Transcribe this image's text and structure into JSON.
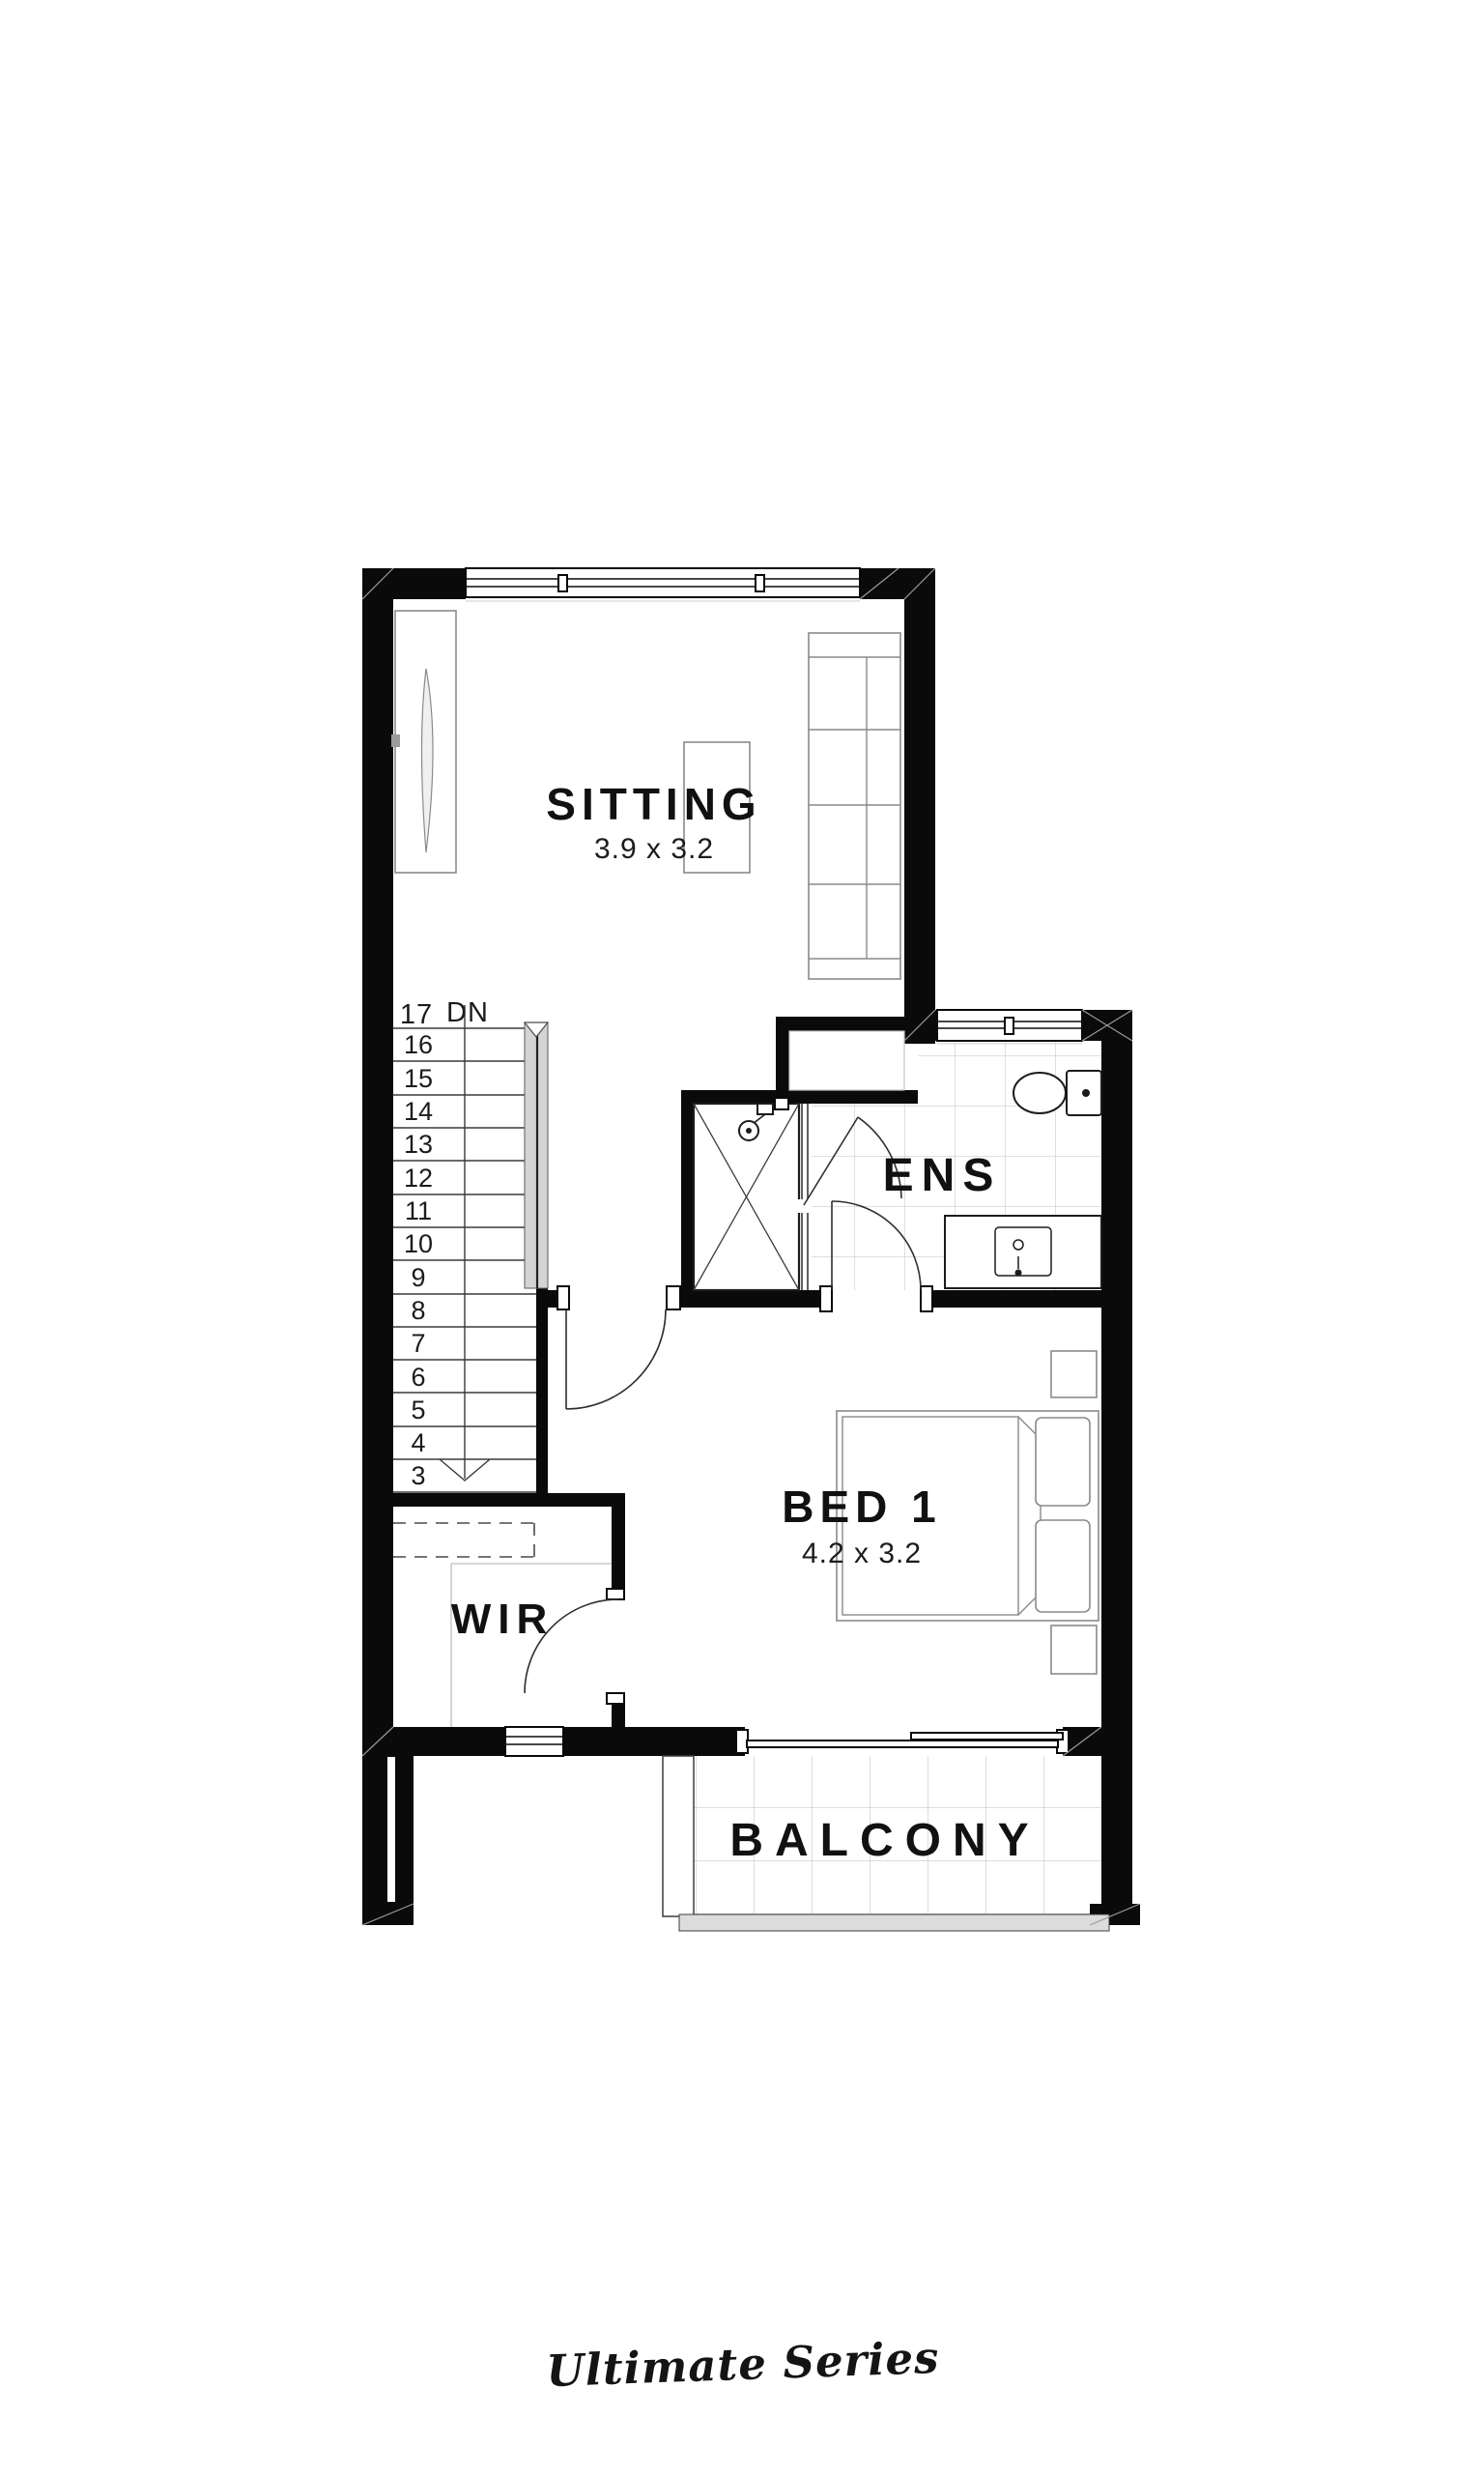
{
  "branding": {
    "series_label": "Ultimate Series"
  },
  "rooms": {
    "sitting": {
      "name": "SITTING",
      "dimensions": "3.9 x 3.2"
    },
    "ens": {
      "name": "ENS"
    },
    "bed1": {
      "name": "BED 1",
      "dimensions": "4.2 x 3.2"
    },
    "wir": {
      "name": "WIR"
    },
    "balcony": {
      "name": "BALCONY"
    }
  },
  "stairs": {
    "top_step_label": "17",
    "direction_label": "DN",
    "step_numbers": [
      "16",
      "15",
      "14",
      "13",
      "12",
      "11",
      "10",
      "9",
      "8",
      "7",
      "6",
      "5",
      "4",
      "3"
    ]
  },
  "colors": {
    "walls": "#0a0a0a",
    "stair_rail": "#d4d4d4",
    "tile_line": "#c9c9c9",
    "balcony_step": "#dcdcdc",
    "text": "#111111"
  }
}
